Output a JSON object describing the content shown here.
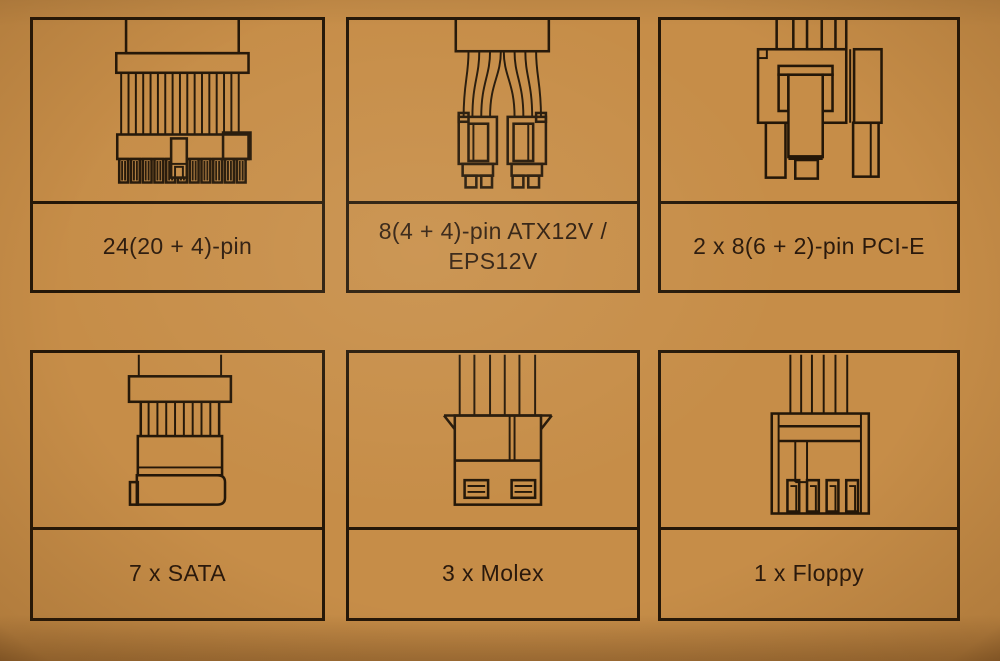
{
  "page": {
    "background_color": "#c68d48",
    "line_color": "#241708",
    "text_color": "#2a190c",
    "description_layout": "2x3 grid of PSU connector diagrams with captions"
  },
  "cells": [
    {
      "id": "atx24",
      "icon": "24pin-atx-connector-icon",
      "label": "24(20 + 4)-pin"
    },
    {
      "id": "eps",
      "icon": "8pin-eps-connector-icon",
      "label": "8(4 + 4)-pin ATX12V / EPS12V"
    },
    {
      "id": "pcie",
      "icon": "8pin-pcie-connector-icon",
      "label": "2 x 8(6 + 2)-pin PCI-E"
    },
    {
      "id": "sata",
      "icon": "sata-connector-icon",
      "label": "7 x SATA"
    },
    {
      "id": "molex",
      "icon": "molex-connector-icon",
      "label": "3 x Molex"
    },
    {
      "id": "floppy",
      "icon": "floppy-connector-icon",
      "label": "1 x Floppy"
    }
  ]
}
